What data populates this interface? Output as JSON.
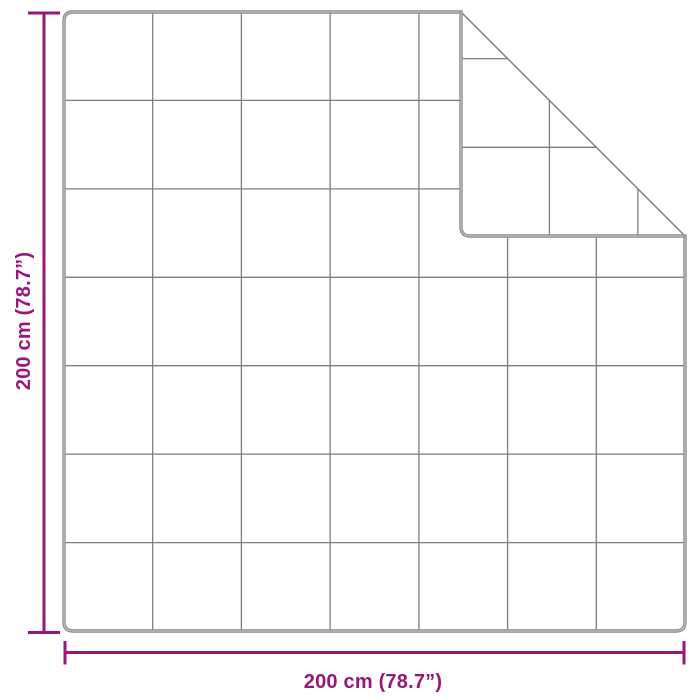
{
  "diagram": {
    "subject": "blanket-dimension-diagram",
    "width_label": "200 cm (78.7”)",
    "height_label": "200 cm (78.7”)",
    "grid_columns": 7,
    "grid_rows": 7,
    "folded_corner": "top-right",
    "colors": {
      "accent": "#98157C",
      "outline": "#8a8a8a",
      "outline_highlight": "#c9c9c9",
      "grid": "#7d7d7d",
      "background": "#ffffff"
    }
  }
}
